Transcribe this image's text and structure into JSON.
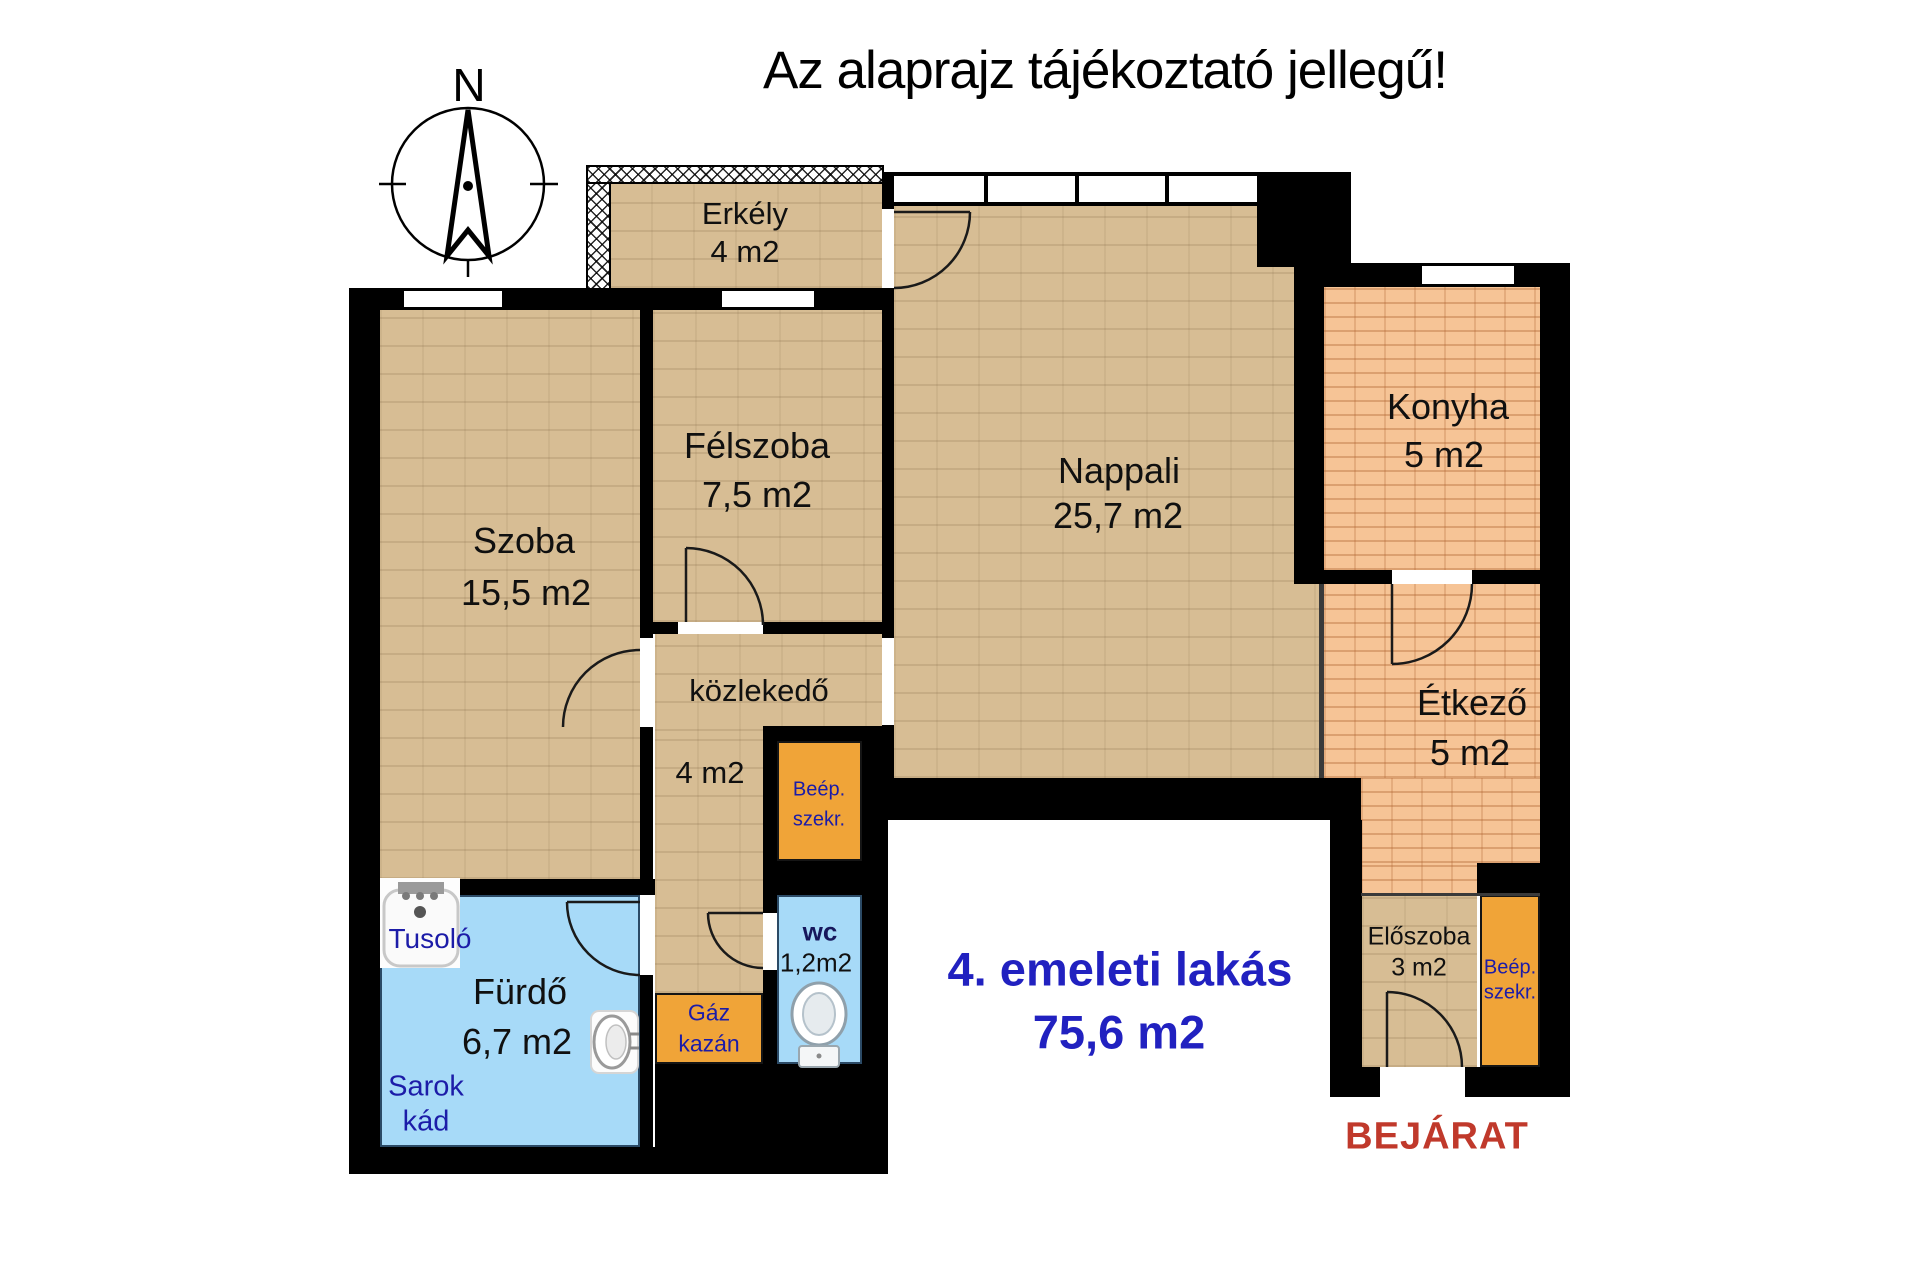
{
  "title": "Az alaprajz tájékoztató jellegű!",
  "compass": {
    "north": "N"
  },
  "rooms": {
    "erkely": {
      "name": "Erkély",
      "area": "4 m2"
    },
    "szoba": {
      "name": "Szoba",
      "area": "15,5 m2"
    },
    "felszoba": {
      "name": "Félszoba",
      "area": "7,5 m2"
    },
    "nappali": {
      "name": "Nappali",
      "area": "25,7 m2"
    },
    "konyha": {
      "name": "Konyha",
      "area": "5 m2"
    },
    "etkezo": {
      "name": "Étkező",
      "area": "5 m2"
    },
    "kozlekedo": {
      "name": "közlekedő",
      "area": "4 m2"
    },
    "furdo": {
      "name": "Fürdő",
      "area": "6,7 m2"
    },
    "wc": {
      "name": "wc",
      "area": "1,2m2"
    },
    "eloszoba": {
      "name": "Előszoba",
      "area": "3 m2"
    }
  },
  "fixtures": {
    "tusolo": "Tusoló",
    "sarok_line1": "Sarok",
    "sarok_line2": "kád",
    "gaz_line1": "Gáz",
    "gaz_line2": "kazán",
    "szekreny_line1": "Beép.",
    "szekreny_line2": "szekr."
  },
  "summary": {
    "line1": "4. emeleti lakás",
    "line2": "75,6 m2"
  },
  "entrance_label": "BEJÁRAT",
  "colors": {
    "wall": "#000000",
    "floor_tan": "#d7bd94",
    "floor_brick": "#f6c496",
    "wet_room_blue": "#a7daf8",
    "cabinet_orange": "#f0a438",
    "label_navy": "#1c1ca8",
    "summary_blue": "#2121c0",
    "entrance_red": "#c0392b"
  }
}
